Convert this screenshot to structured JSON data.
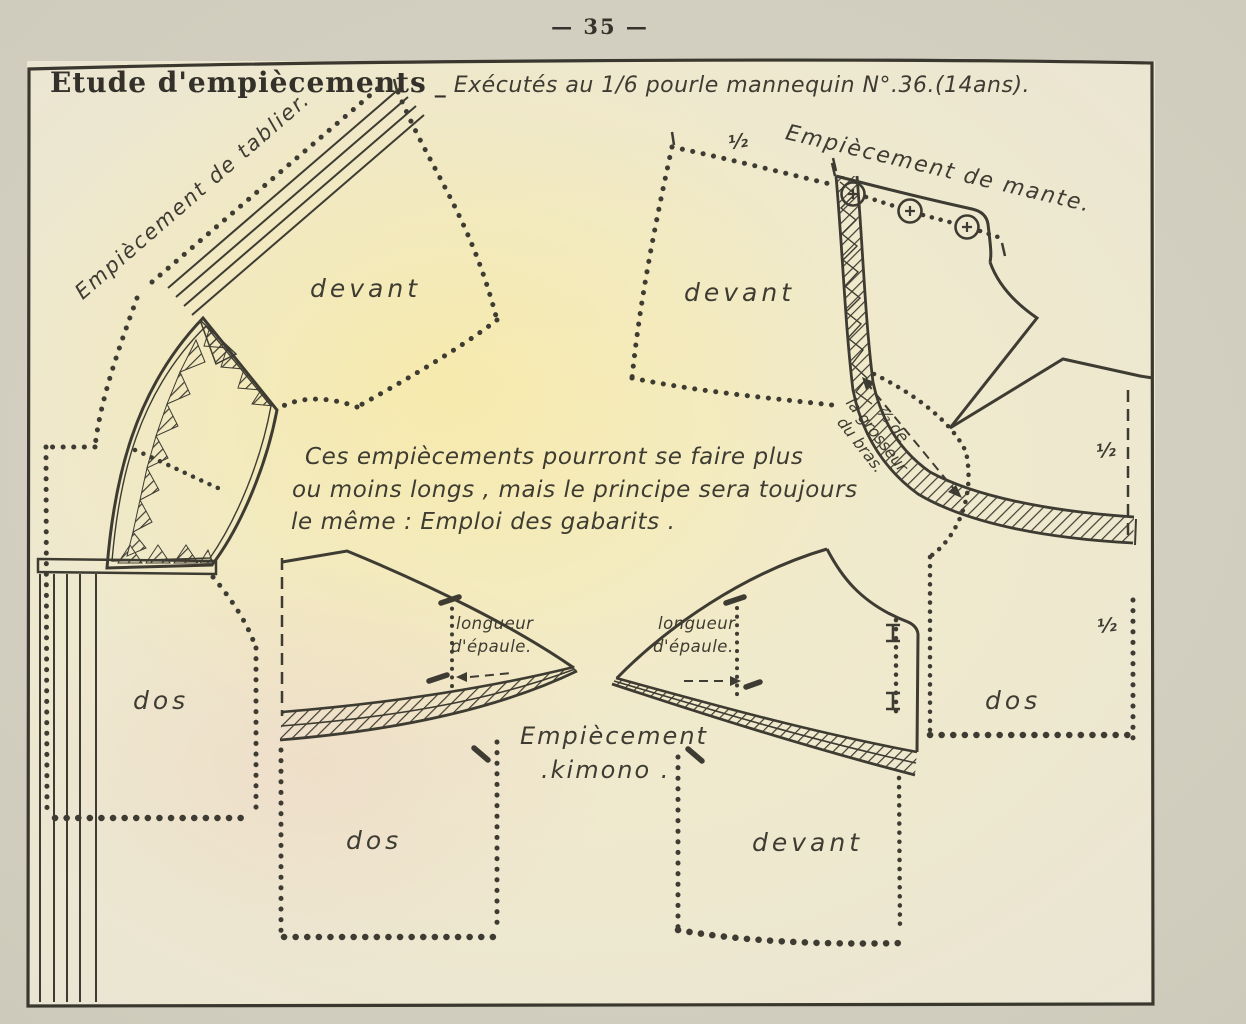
{
  "page": {
    "number": "— 35 —"
  },
  "header": {
    "title": "Etude d'empiècements",
    "separator": "_",
    "subtitle": "Exécutés au 1/6 pourle mannequin N°.36.(14ans)."
  },
  "note": {
    "line1": "Ces empiècements pourront se faire plus",
    "line2": "ou moins longs , mais le principe sera toujours",
    "line3": "le même : Emploi des gabarits ."
  },
  "labels": {
    "tablier": "Empiècement de tablier.",
    "mante": "Empiècement de mante.",
    "kimono_line1": "Empiècement",
    "kimono_line2": ".kimono .",
    "devant_tablier": "devant",
    "devant_mante": "devant",
    "devant_kimono": "devant",
    "dos_tablier": "dos",
    "dos_kimono": "dos",
    "dos_mante": "dos",
    "half_mante_top": "½",
    "half_mante_right": "½",
    "half_dos_right": "½",
    "grosseur_line1": "⅔ de",
    "grosseur_line2": "la grosseur",
    "grosseur_line3": "du bras.",
    "longueur_left_line1": "longueur",
    "longueur_left_line2": "d'épaule.",
    "longueur_right_line1": "longueur",
    "longueur_right_line2": "d'épaule."
  },
  "colors": {
    "ink": "#3e3c32",
    "paper": "#eee8d2",
    "paper_margin": "#d3cfc1",
    "warm_center": "#f6edc2"
  }
}
